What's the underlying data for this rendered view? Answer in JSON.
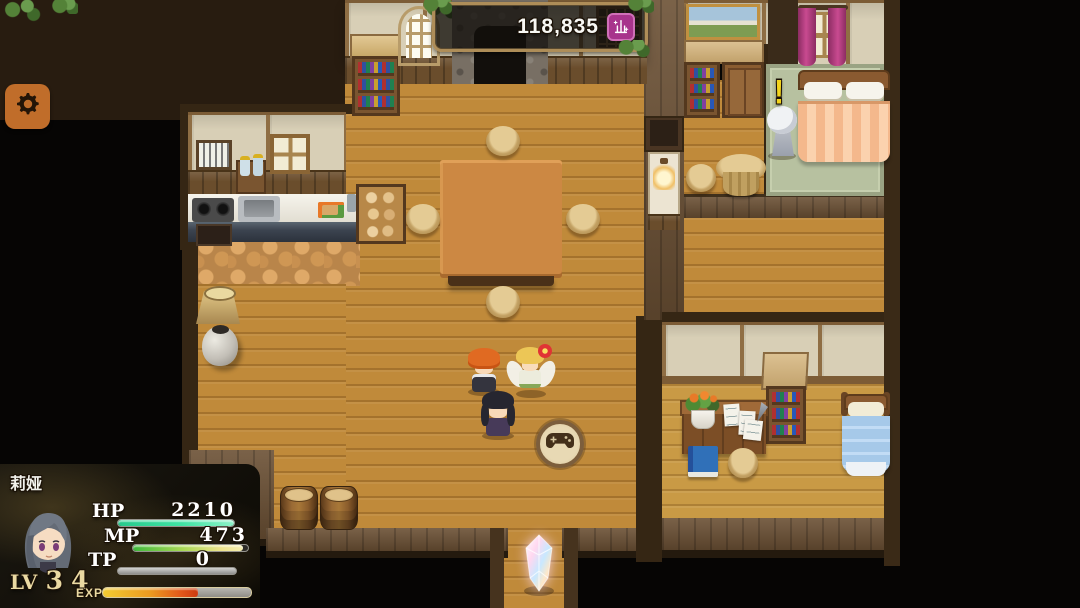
{
  "hud": {
    "settings_button": {
      "icon": "gear-icon",
      "bg_color": "#c06d2a"
    },
    "currency_bar": {
      "value": "118,835",
      "icon": "guild-shop-icon",
      "icon_bg": "#a8348c"
    },
    "touch_button": {
      "icon": "gamepad-icon"
    },
    "status_panel": {
      "name": "莉娅",
      "bars": [
        {
          "label": "HP",
          "value": "2210",
          "percent": 100
        },
        {
          "label": "MP",
          "value": "473",
          "percent": 96
        },
        {
          "label": "TP",
          "value": "0",
          "percent": 0
        }
      ],
      "level_label": "LV",
      "level_value": "34",
      "exp_label": "EXP",
      "exp_percent": 64
    }
  },
  "scene": {
    "npc_alert_mark": "!",
    "colors": {
      "floor_wood": "#c08a3a",
      "wall_panel": "#d8cfb6",
      "wall_band": "#6b5034",
      "border_dark": "#352614",
      "hp_fill": "#3fe3a4",
      "mp_fill": "#a8d855",
      "exp_fill": "#eb9a20",
      "carpet": "#b7c1a0",
      "curtain": "#b03878",
      "bed_blanket_orange": "#f4b88c",
      "bed_blanket_blue": "#a6c9e9"
    }
  }
}
